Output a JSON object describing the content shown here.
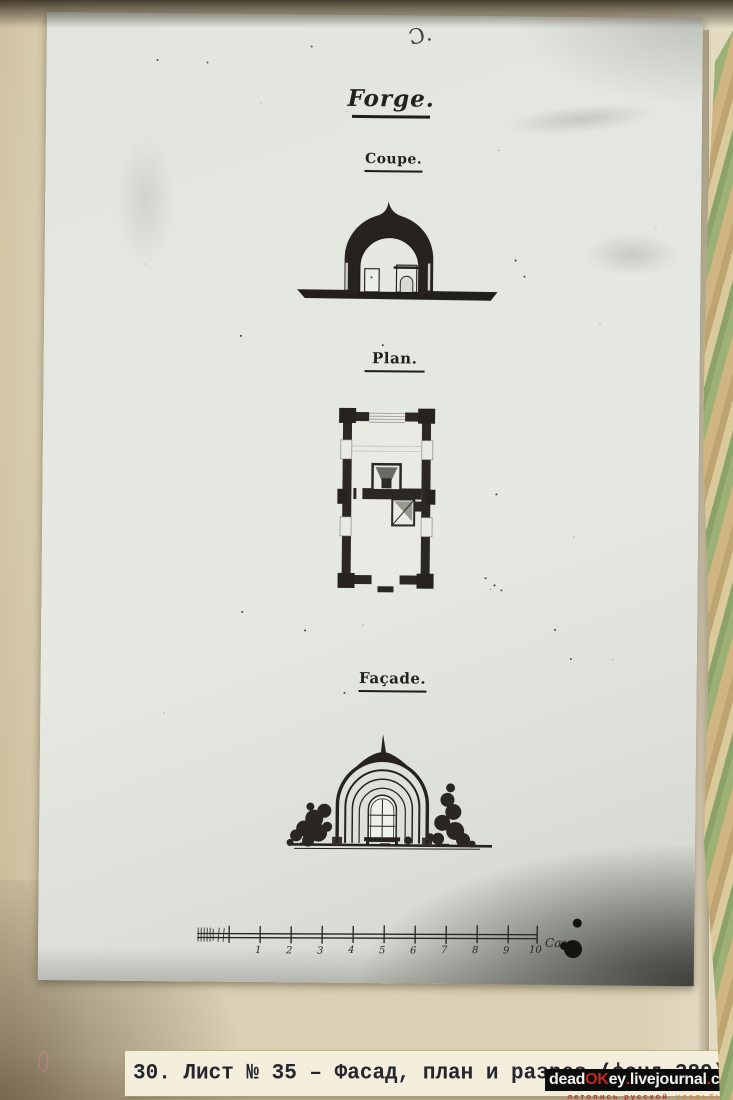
{
  "page": {
    "plate": {
      "handwritten_mark": "Ɔ.",
      "title": "Forge.",
      "sections": {
        "coupe": "Coupe.",
        "plan": "Plan.",
        "facade": "Façade."
      },
      "scale_bar": {
        "tick_labels": [
          "1",
          "2",
          "3",
          "4",
          "5",
          "6",
          "7",
          "8",
          "9",
          "10"
        ],
        "unit_label": "Саж."
      }
    },
    "caption": {
      "text": "30. Лист № 35 – Фасад, план и разрез (фонд 389)"
    },
    "watermark": {
      "site": [
        {
          "text": "dead",
          "color": "#f2f2ee"
        },
        {
          "text": "OK",
          "color": "#c8261d"
        },
        {
          "text": "ey",
          "color": "#f2f2ee"
        },
        {
          "text": ".",
          "color": "#c8261d"
        },
        {
          "text": "livejournal",
          "color": "#f2f2ee"
        },
        {
          "text": ".",
          "color": "#c8261d"
        },
        {
          "text": "com",
          "color": "#f2f2ee"
        }
      ],
      "tagline": [
        {
          "text": "летопись русской",
          "color": "#b23227"
        },
        {
          "text": "усадьбы",
          "color": "#cd8a3e"
        }
      ]
    },
    "colors": {
      "album_page": "#d8ccae",
      "photo_print": "#e4e7e0",
      "drawing_ink": "#23201c",
      "watermark_red": "#c8261d",
      "tagline_orange": "#cd8a3e"
    }
  }
}
